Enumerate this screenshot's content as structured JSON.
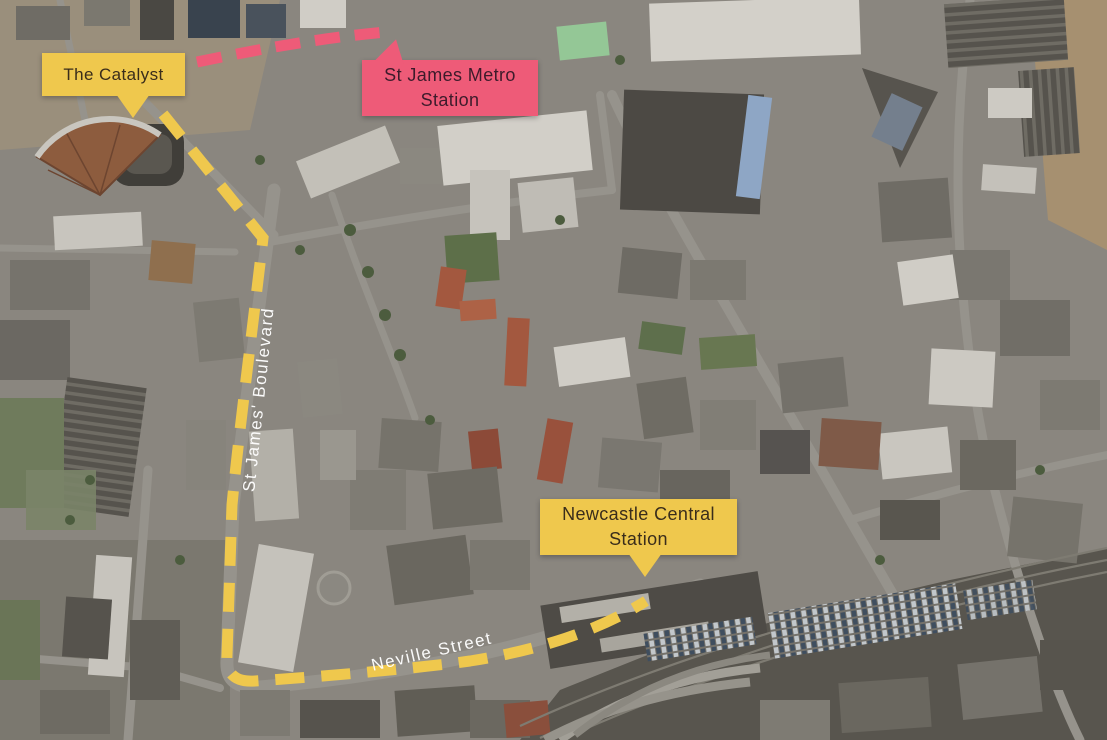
{
  "map": {
    "type": "aerial-satellite-route-map",
    "colors": {
      "route_yellow": "#EFC84D",
      "metro_pink": "#EE5B78",
      "label_text_on_yellow": "#3A2D1B",
      "label_text_on_pink": "#3D1B2B",
      "street_text": "#FFFFFF"
    },
    "labels": {
      "catalyst": {
        "text": "The Catalyst"
      },
      "metro_station": {
        "line1": "St James Metro",
        "line2": "Station"
      },
      "central_station": {
        "line1": "Newcastle Central",
        "line2": "Station"
      }
    },
    "streets": {
      "boulevard": "St James' Boulevard",
      "neville": "Neville Street"
    }
  }
}
